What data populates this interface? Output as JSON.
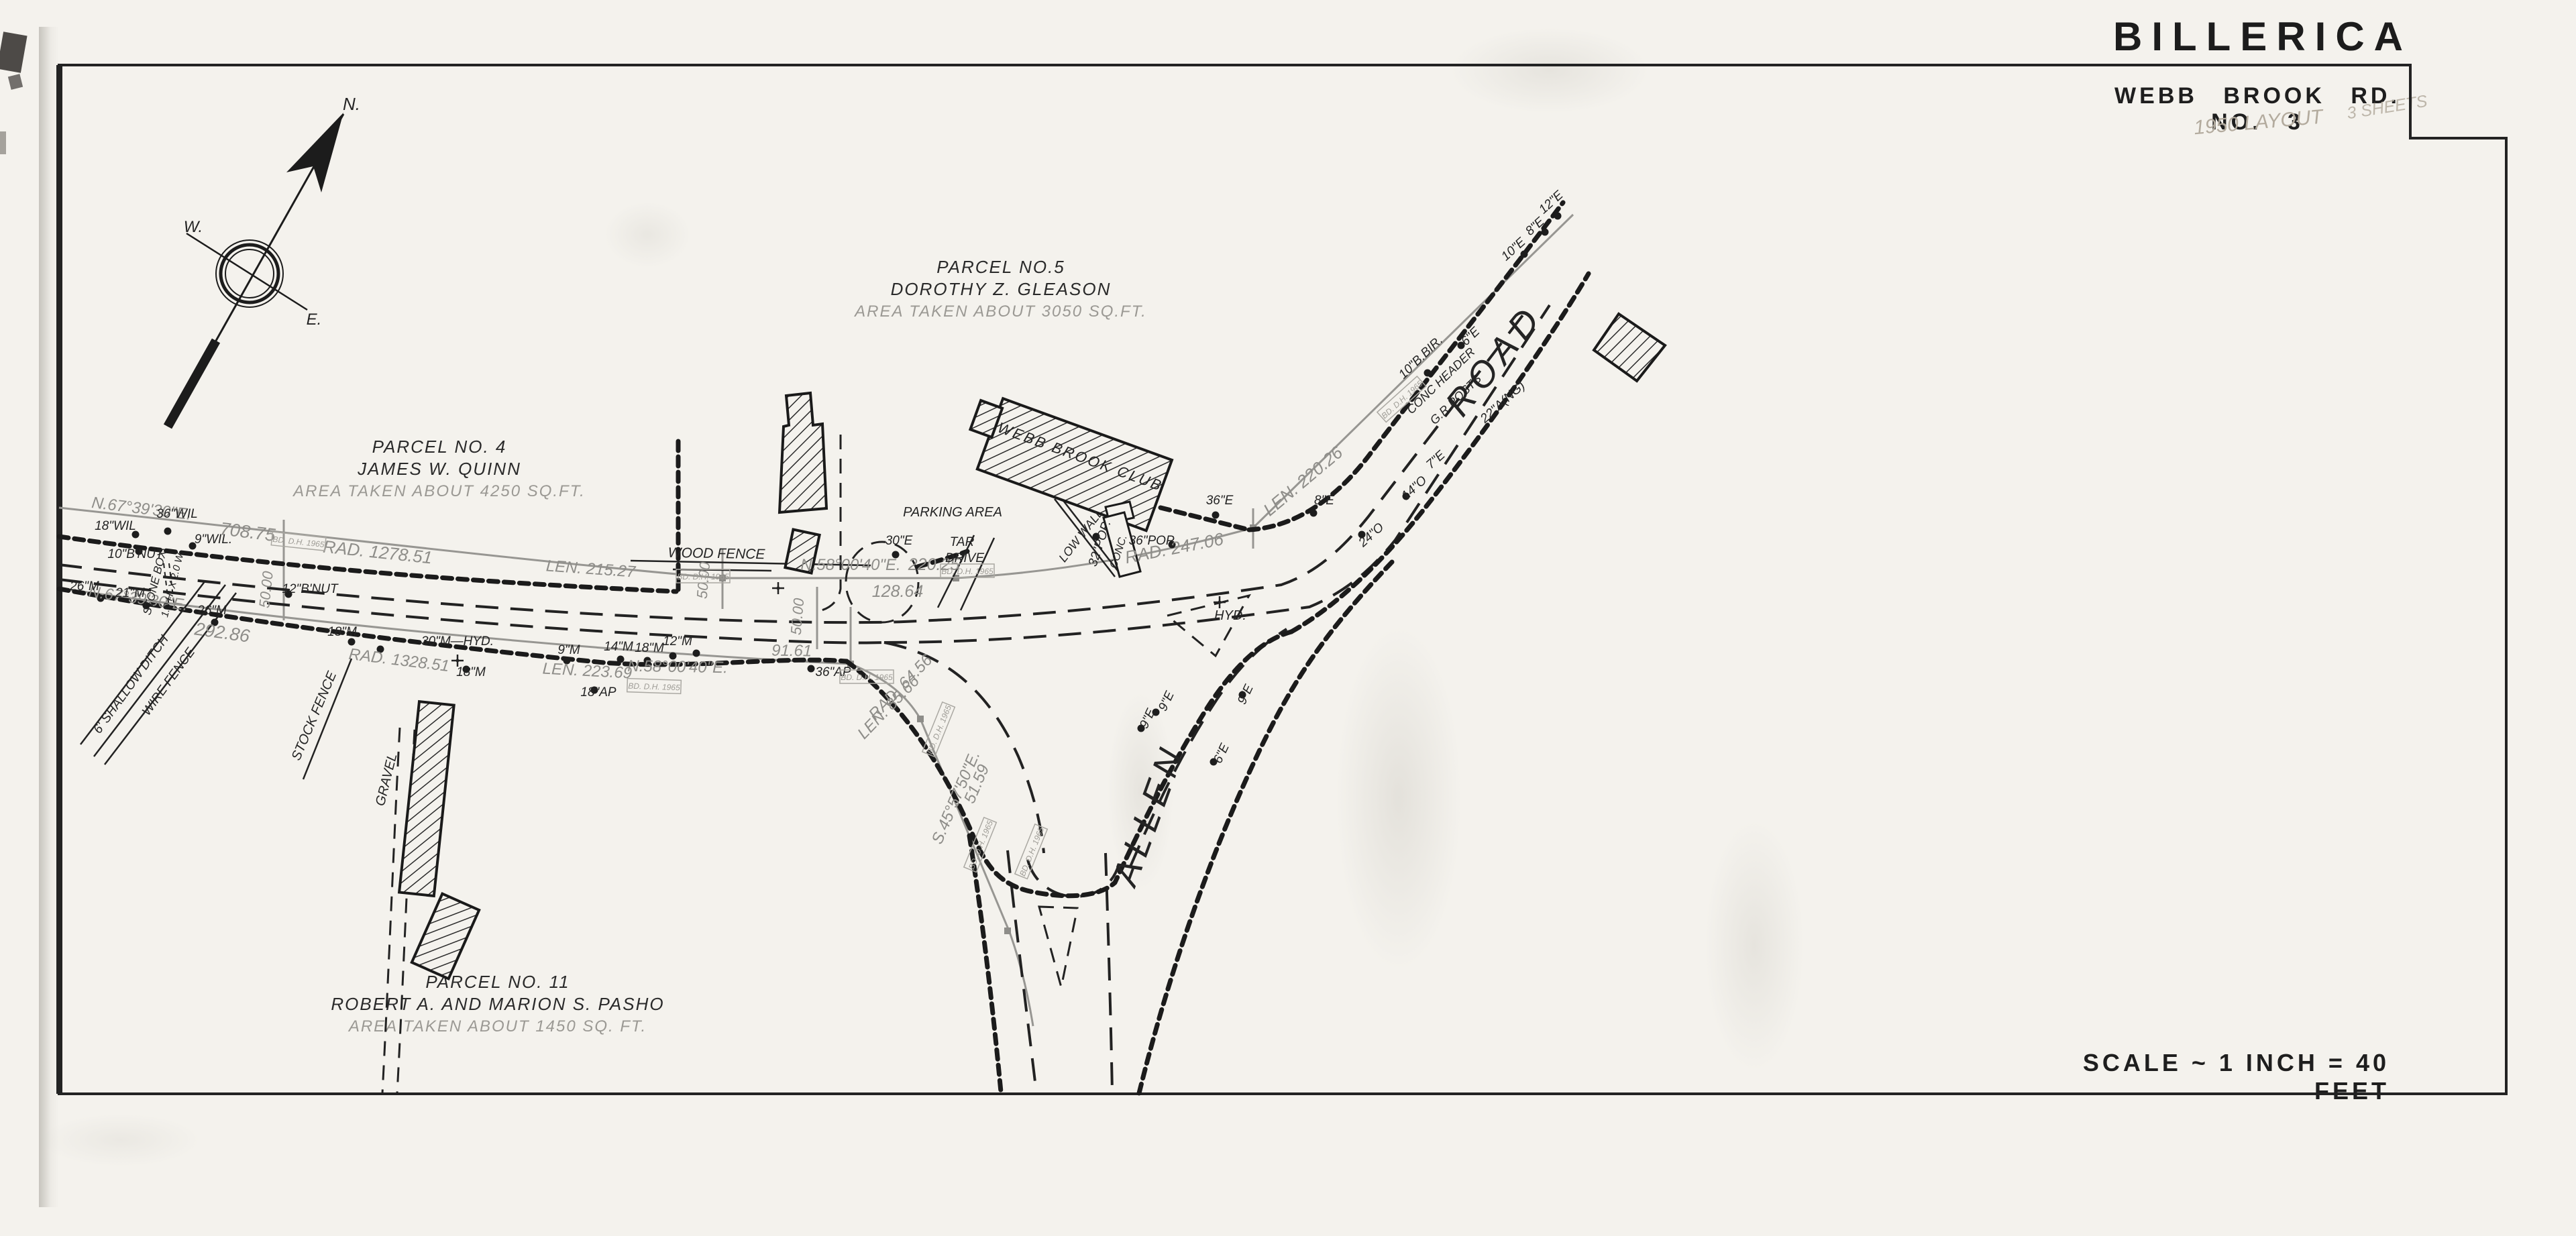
{
  "title": {
    "city": "BILLERICA",
    "sheet": "WEBB BROOK RD. NO. 3",
    "handwritten_year": "1950 LAYOUT",
    "handwritten_sheets": "3 SHEETS",
    "scale": "SCALE ~ 1 INCH = 40 FEET"
  },
  "parcels": [
    {
      "name": "PARCEL NO.5",
      "owner": "DOROTHY Z. GLEASON",
      "area": "AREA TAKEN ABOUT 3050 SQ.FT."
    },
    {
      "name": "PARCEL NO. 4",
      "owner": "JAMES W. QUINN",
      "area": "AREA TAKEN ABOUT 4250 SQ.FT."
    },
    {
      "name": "PARCEL NO. 11",
      "owner": "ROBERT A. AND MARION S. PASHO",
      "area": "AREA TAKEN ABOUT 1450 SQ. FT."
    }
  ],
  "survey_stamp": "BD. D.H. 1965",
  "map_labels": {
    "compass_n": "N.",
    "compass_w": "W.",
    "compass_e": "E.",
    "bearing_nw_top": "N.67°39'30\"E.",
    "dist_70875": "708.75",
    "rad_127851": "RAD. 1278.51",
    "len_21527": "LEN. 215.27",
    "bearing_nw_bot": "N.67°39'30\"E.",
    "dist_29286": "292.86",
    "rad_132851": "RAD. 1328.51",
    "len_22369": "LEN. 223.69",
    "bearing_n58_mid": "N.58°00'40\"E.",
    "dist_22025": "220.25",
    "dist_12864": "128.64",
    "bearing_n58_low": "N.58°00'40\"E.",
    "dist_9161": "91.61",
    "rad_6456": "RAD. 64.56",
    "len_8566": "LEN. 85.66",
    "bearing_s45": "S.45°57'50\"E.",
    "dist_5159": "51.59",
    "rad_24706": "RAD. 247.06",
    "len_22026": "LEN. 220.26",
    "sta_a": "50.00",
    "sta_b": "50.00",
    "sta_c": "50.00",
    "wood_fence": "WOOD FENCE",
    "stone_box": "STONE BOX",
    "stone_box_size": "1.0 H. X 2.0 W.",
    "ditch": "6' SHALLOW DITCH",
    "wire_fence": "WIRE FENCE",
    "stock_fence": "STOCK FENCE",
    "gravel": "GRAVEL",
    "parking": "PARKING AREA",
    "tar": "TAR",
    "drive": "DRIVE",
    "low_wall": "LOW WALL",
    "conc": "CONC.",
    "conc_header": "CONC HEADER",
    "gr_posts": "G.R.POSTS",
    "hyd_island": "HYD.",
    "m30_hyd": "30\"M—HYD.",
    "club": "WEBB BROOK CLUB",
    "road": "ROAD",
    "allen": "ALLEN",
    "t_36wil": "36\"WIL",
    "t_18wil": "18\"WIL",
    "t_9wil": "9\"WIL.",
    "t_10bnut": "10\"B'NUT",
    "t_12bnut": "12\"B'NUT",
    "t_26m_a": "26\"M",
    "t_21m": "21\"M",
    "t_26m_b": "26\"M",
    "t_18m_a": "18\"M",
    "t_18m_b": "18\"M",
    "t_9m": "9\"M",
    "t_14m": "14\"M",
    "t_18m_c": "18\"M",
    "t_12m": "12\"M",
    "t_18ap": "18\"AP",
    "t_36ap": "36\"AP",
    "t_30e": "30\"E",
    "t_36e": "36\"E",
    "t_36pop": "36\"POP.",
    "t_32pop": "32\"POP.",
    "t_8e_a": "8\"E",
    "t_24o": "24\"O",
    "t_14o": "14\"O",
    "t_7e": "7\"E",
    "t_10e": "10\"E",
    "t_8e_b": "8\"E",
    "t_12e": "12\"E",
    "t_10bbir": "10\"B.BIR.",
    "t_6e_a": "6\"E",
    "t_22ang": "22\"A(NG)",
    "t_9e_a": "9\"E",
    "t_9e_b": "9\"E",
    "t_9e_c": "9\"E",
    "t_6e_b": "6\"E"
  },
  "colors": {
    "ink": "#232323",
    "pencil": "#8e8d89",
    "hand": "#b3ab9e",
    "paper": "#f4f2ed"
  }
}
